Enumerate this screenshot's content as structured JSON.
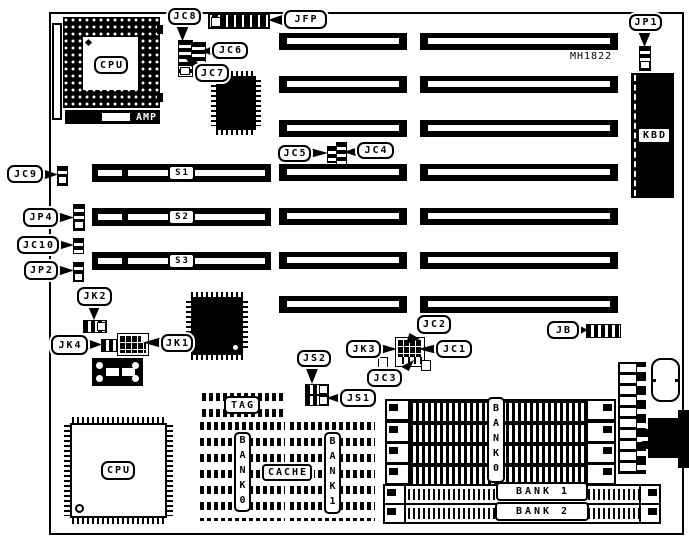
{
  "board": {
    "id_text": "MH1822"
  },
  "labels": {
    "jc8": "JC8",
    "jfp": "JFP",
    "jc6": "JC6",
    "jc7": "JC7",
    "jp1": "JP1",
    "jc5": "JC5",
    "jc4": "JC4",
    "jc9": "JC9",
    "jp4": "JP4",
    "jc10": "JC10",
    "jp2": "JP2",
    "jk2": "JK2",
    "jk4": "JK4",
    "jk1": "JK1",
    "jc2": "JC2",
    "jk3": "JK3",
    "jc1": "JC1",
    "jc3": "JC3",
    "js2": "JS2",
    "js1": "JS1",
    "jb": "JB"
  },
  "chips": {
    "cpu_socket": "CPU",
    "amp": "AMP",
    "cpu": "CPU",
    "kbd": "KBD"
  },
  "slots": {
    "s1": "S1",
    "s2": "S2",
    "s3": "S3",
    "isa_rows": 7
  },
  "cache": {
    "tag": "TAG",
    "cache": "CACHE",
    "bank0": "BANK0",
    "bank1": "BANK1"
  },
  "memory": {
    "simm_bank0": "BANK0",
    "simm_bank1": "BANK 1",
    "simm_bank2": "BANK 2",
    "bank0_rows": 4
  },
  "colors": {
    "ink": "#000000",
    "paper": "#ffffff"
  }
}
